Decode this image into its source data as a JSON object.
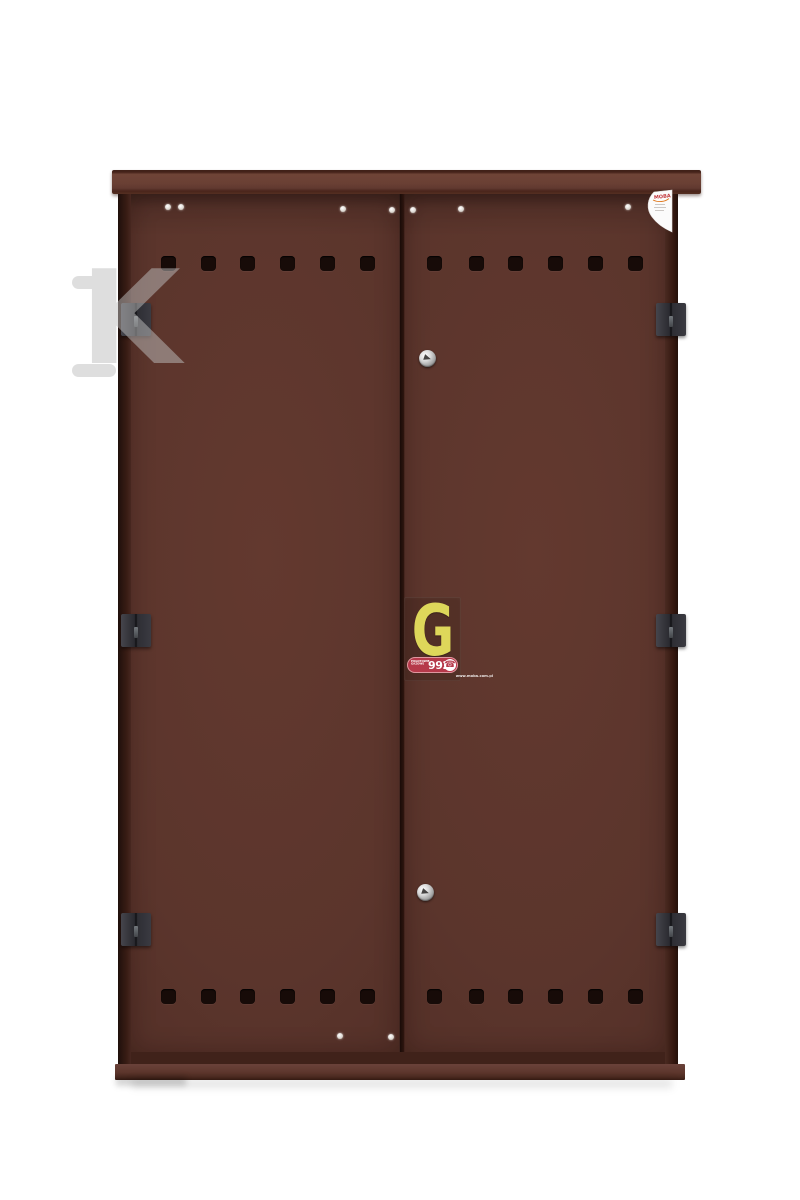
{
  "meta": {
    "description": "Product photo of a brown two-door steel gas meter cabinet on white background",
    "background_color": "#ffffff"
  },
  "cabinet": {
    "door_color": "#5a342c",
    "frame_color": "#40221a",
    "lid_color": "#6a4034",
    "hinge_color": "#2a2a30",
    "vent_hole_color": "#170b08",
    "hinge_count": 6,
    "vent_holes_per_row": 12,
    "lock_count": 2
  },
  "gas_sticker": {
    "letter": "G",
    "letter_color": "#ded75a",
    "band_color": "#b6394a",
    "line1": "POGOTOWIE",
    "line2": "GAZOWE",
    "number": "992",
    "phone_icon": "☎",
    "website": "www.moba.com.pl"
  },
  "corner_sticker": {
    "brand": "MOBA",
    "brand_color": "#c2383d"
  },
  "watermark": {
    "letter": "K",
    "color": "#bfbfbf"
  }
}
